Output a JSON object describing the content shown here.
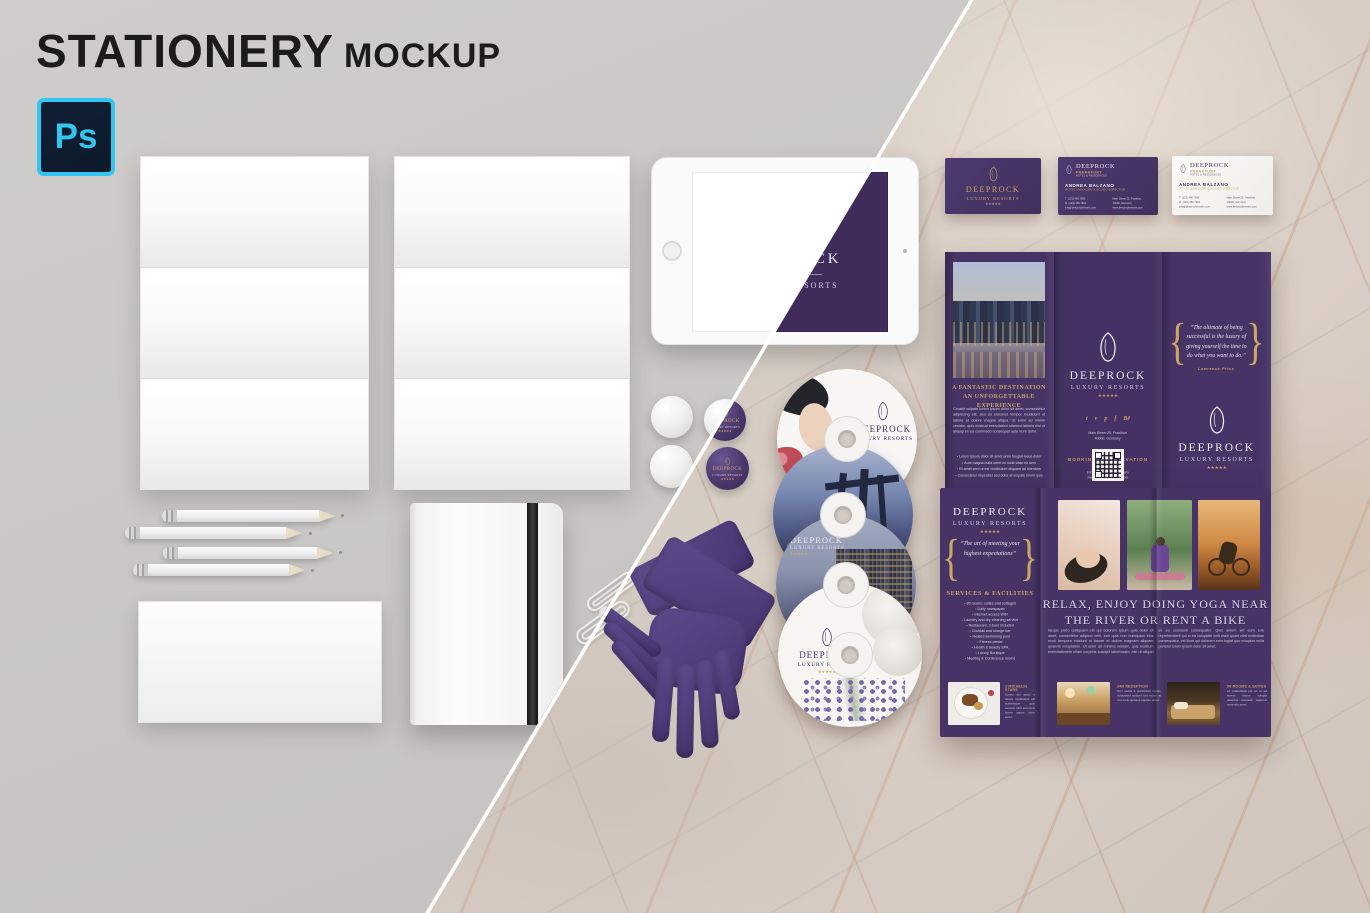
{
  "colors": {
    "bg_gray": "#cac9c7",
    "marble_base": "#d8d0c9",
    "brand_purple": "#473366",
    "deep_purple": "#3f2c5b",
    "gold": "#c9a866",
    "glove_purple": "#533e7c",
    "ps_cyan": "#31c5f0",
    "ps_navy": "#0c1a2b"
  },
  "header": {
    "title": "STATIONERY",
    "subtitle": "MOCKUP"
  },
  "ps_badge": {
    "label": "Ps"
  },
  "brand": {
    "name": "DEEPROCK",
    "tagline": "LUXURY RESORTS",
    "stars": "★★★★★"
  },
  "tablet_screen": {
    "brand": "DEEPROCK",
    "tagline": "LUXURY RESORTS"
  },
  "pin": {
    "brand": "DEEPROCK",
    "tagline": "LUXURY RESORTS",
    "stars": "★★★★★"
  },
  "business_cards": {
    "front": {
      "brand": "DEEPROCK",
      "tagline": "LUXURY RESORTS",
      "stars": "★★★★★"
    },
    "purple_detail": {
      "brand": "DEEPROCK",
      "city": "FRANKFURT",
      "subline": "HOTEL & RESIDENCES",
      "person": "ANDREA BALZANO",
      "role": "HOTEL MANAGER & BOARD DIRECTOR",
      "contact_left": [
        "T. (123) 456 7890",
        "M. (123) 456 7891",
        "info@deeprockresorts.com"
      ],
      "contact_right": [
        "Main Street 25, Frankfurt",
        "40000, Germany",
        "www.deeprockresorts.com"
      ]
    },
    "white_detail": {
      "brand": "DEEPROCK",
      "city": "FRANKFURT",
      "subline": "HOTEL & RESIDENCES",
      "person": "ANDREA BALZANO",
      "role": "HOTEL MANAGER & BOARD DIRECTOR",
      "contact_left": [
        "T. (123) 456 7890",
        "M. (123) 456 7891",
        "info@deeprockresorts.com"
      ],
      "contact_right": [
        "Main Street 25, Frankfurt",
        "40000, Germany",
        "www.deeprockresorts.com"
      ]
    }
  },
  "cds": {
    "disc_photo": {
      "brand": "DEEPROCK",
      "tagline": "LUXURY RESORTS"
    },
    "disc_city": {
      "brand": "DEEPROCK",
      "tagline": "LUXURY RESORTS",
      "stars": "★★★★★"
    },
    "disc_lavender": {
      "brand": "DEEPROCK",
      "tagline": "LUXURY RESORTS",
      "stars": "★★★★★"
    }
  },
  "brochure_outside": {
    "left": {
      "heading_line1": "A FANTASTIC DESTINATION",
      "heading_line2": "AN UNFORGETTABLE EXPERIENCE",
      "body": "Curabit vulpate lorem ipsum dolor sit amet, consectetur adipiscing elit, sed do eiusmod tempor incididunt ut labore et dolore magna aliqua. Ut enim ad minim veniam, quis nostrud exercitation ullamco laboris nisi ut aliquip ex ea commodo consequat aute irure dolor.",
      "bullets": [
        "Lorem ipsum dolor sit amet enim feugiat lacus dolor",
        "Aute magna nulla amet mi nulla vitae eu sem",
        "Et amet sem ut est vestibulum aliquam ad interdum",
        "Consectetur imperdiet sed dolor et vulpate lorem quis"
      ]
    },
    "middle": {
      "brand": "DEEPROCK",
      "tagline": "LUXURY RESORTS",
      "stars": "★★★★★",
      "social_icons": [
        "twitter-icon",
        "vimeo-icon",
        "pinterest-icon",
        "facebook-icon",
        "behance-icon"
      ],
      "address_line1": "Main Street 25, Frankfurt",
      "address_line2": "40000, Germany",
      "booking_label": "BOOKING & RESERVATION",
      "phone": "(123) 456 7890",
      "email": "info@deeprockresorts.com",
      "website": "www.deeprockresorts.com"
    },
    "right": {
      "quote": "“The ultimate of being successful is the luxury of giving yourself the time to do what you want to do.”",
      "attribution": "Lawrence Price",
      "brand": "DEEPROCK",
      "tagline": "LUXURY RESORTS",
      "stars": "★★★★★"
    }
  },
  "brochure_inside": {
    "left": {
      "brand": "DEEPROCK",
      "tagline": "LUXURY RESORTS",
      "stars": "★★★★★",
      "quote": "“The art of meeting your highest expectations”",
      "services_heading": "SERVICES & FACILITIES",
      "services": [
        "80 rooms, suites and cottages",
        "Daily newspaper",
        "Internet access WiFi",
        "Laundry and dry cleaning service",
        "Restaurant, 3 bars included",
        "Cocktail and lounge bar",
        "Heated swimming pool",
        "Fitness center",
        "Health & beauty SPA",
        "Luxury Boutique",
        "Meeting & Conference rooms"
      ],
      "michelin_caption": "2 MICHELIN STARS",
      "michelin_text": "Donec dui quod a dolore vestibulum elit scelerisque quis sempre nibh sem quis lorem ipsum dolor amet."
    },
    "right": {
      "headline_line1": "RELAX, ENJOY DOING YOGA NEAR",
      "headline_line2": "THE RIVER OR RENT A BIKE",
      "body": "Neque porro quisquam est qui dolorem ipsum quia dolor sit amet, consectetur adipisci velit, sed quia non numquam eius modi tempora incidunt ut labore et dolore magnam aliquam quaerat voluptatem. Ut enim ad minima veniam, quis nostrum exercitationem ullam corporis suscipit laboriosam, nisi ut aliquid ex ea commodi consequatur. Quis autem vel eum iure reprehenderit qui in ea voluptate velit esse quam nihil molestiae consequatur, vel illum qui dolorem eum fugiat quo voluptas nulla pariatur lorem ipsum dolor sit amet.",
      "reception_caption": "24H RECEPTION",
      "reception_text": "Orci sodipi it auctoribus harum vulputated sodium sint volunt at nos meis quibans natolae amet.",
      "rooms_caption": "50 ROOMS & SUITES",
      "rooms_text": "At malesuada est an ut ea autem neque volupta delectus iluspada sapimus portendo amet."
    }
  }
}
